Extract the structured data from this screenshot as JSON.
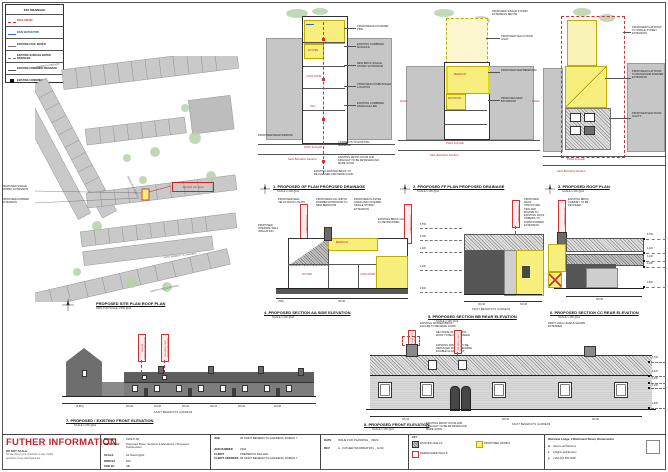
{
  "colors": {
    "accent_red": "#c0272d",
    "proposed_yellow": "#f6ef7d",
    "existing_gray": "#565656",
    "map_gray": "#c6c6c6",
    "tree_green": "#b7d2ab",
    "rain_blue": "#2d6fc0"
  },
  "legend": {
    "title": "KEY DRAINAGE",
    "items": [
      {
        "label": "FOUL DRAIN",
        "symbol": "red-dashed-line"
      },
      {
        "label": "RAIN WATER PIPE",
        "symbol": "blue-line"
      },
      {
        "label": "EXISTING FOUL WATER",
        "symbol": "gray-line"
      },
      {
        "label": "EXISTING SURFACE WATER DRAINAGE",
        "symbol": "gray-line"
      },
      {
        "label": "EXISTING COMBINED DRAINAGE",
        "symbol": "gray-line"
      },
      {
        "label": "EXISTING COMBINED RJ",
        "symbol": "black-square"
      }
    ]
  },
  "site_plan": {
    "caption": "PROPOSED SITE PLAN ROOF PLAN",
    "scale": "DWG P-60   SCALE 1:500 @A1",
    "streets": {
      "top": "HAMPDEN PARADE",
      "left": "GERALDINE STREET",
      "middle": "SAINT BENEDICTS GARDENS",
      "bottom": "NORTH CIRCULAR ROAD"
    },
    "notes": [
      "PROPOSED SINGLE STOREY EXTENSION",
      "PROPOSED DORMER EXTENSION"
    ],
    "site_label": "Site Red Line Area"
  },
  "plans": [
    {
      "num": "1.",
      "caption": "PROPOSED GF PLAN PROPOSED DRAINAGE",
      "scale": "SCALE 1:100 @A1",
      "rooms": [
        "KITCHEN",
        "LIVING ROOM",
        "HALL"
      ],
      "notes_right": [
        "PROPOSED RAIN WATER PIPE",
        "EXISTING COMBINED MANHOLE",
        "NEW BRICK SINGLE STOREY EXTENSION",
        "PROPOSED COMBI BOILER LOCATION",
        "EXISTING COMBINED DRAINAGE LINE"
      ],
      "note_left": "PROPOSED REAR WINDOW",
      "notes_bottom": [
        "CONNECTS TO EXISTING MANHOLE",
        "EXISTING FRONT DOOR AND FANLIGHT TO BE RETAINED AND MADE GOOD",
        "EXISTING PAINTED BRICK TO BE CLEANED AND MADE GOOD"
      ],
      "footpath": "Public Footpath",
      "street": "Saint Benedicts Gardens"
    },
    {
      "num": "2.",
      "caption": "PROPOSED FF PLAN PROPOSED DRAINAGE",
      "scale": "SCALE 1:100 @A1",
      "rooms": [
        "BEDROOM",
        "BATHROOM"
      ],
      "note_top": "PROPOSED SINGLE STOREY EXTENSION BELOW",
      "notes_right": [
        "PROPOSED VELUX ROOF LIGHT",
        "PROPOSED NEW BEDROOM",
        "PROPOSED NEW BATHROOM"
      ],
      "road_left": "ROAD",
      "road_right": "ROAD",
      "footpath": "Public Footpath",
      "street": "Saint Benedicts Gardens"
    },
    {
      "num": "3.",
      "caption": "PROPOSED ROOF PLAN",
      "scale": "SCALE 1:100 @A1",
      "notes_right": [
        "PROPOSED FLAT ROOF TO SINGLE STOREY EXTENSION",
        "PROPOSED FLAT ROOF TO BATHROOM DORMER EXTENSION",
        "PROPOSED NEW ROOF LIGHTS"
      ],
      "footpath": "Public Footpath",
      "street": "Saint Benedicts Gardens"
    }
  ],
  "sections": [
    {
      "num": "4.",
      "caption": "PROPOSED SECTION AA SIDE ELEVATION",
      "scale": "SCALE 1:100 @A1",
      "notes": [
        "PROPOSED NEW VELUX ROOF LIGHTS",
        "PROPOSED FULL WIDTH DORMER EXTENSION TO NEW BEDROOM",
        "PROPOSED PLASTER LINED AND COVERED SINGLE STOREY EXTENSION",
        "EXISTING BRICK CHIMNEY TO BE RETAINED",
        "PROPOSED INTERNAL WALL INSULATION"
      ],
      "rooms": [
        "BEDROOM",
        "KITCHEN",
        "LIVING ROOM"
      ],
      "flag": "SITE BOUNDARY",
      "dims": [
        "(765)",
        "NO.36"
      ]
    },
    {
      "num": "5.",
      "caption": "PROPOSED SECTION BB REAR ELEVATION",
      "scale": "SCALE 1:100 @A1",
      "note_top": "PROPOSED ROOF STRUCTURE TIED AND BOLTED TO EXISTING ROOF TIMBERS TO FORM DORMER EXTENSION",
      "levels": [
        "5,765",
        "5,100",
        "4,420",
        "2,400",
        "0,000"
      ],
      "flag": "SITE BOUNDARY",
      "dims": [
        "NO.36",
        "NO.38"
      ],
      "street": "SAINT BENEDICTS GARDENS",
      "note_bottom": "EXISTING PAINTED BRICK FACADE TO BE MADE GOOD"
    },
    {
      "num": "6.",
      "caption": "PROPOSED SECTION CC REAR ELEVATION",
      "scale": "SCALE 1:100 @A1",
      "note_top": "EXISTING BRICK CHIMNEY TO BE RETAINED",
      "levels": [
        "5,765",
        "4,420",
        "3,100",
        "2,400",
        "0,000"
      ],
      "flag": "SITE BOUNDARY",
      "dims": [
        "NO.36"
      ],
      "note_bottom": "PARTY WALL LEVELS SHOWN EXTENDED"
    }
  ],
  "elevations": [
    {
      "num": "7.",
      "caption": "PROPOSED / EXISTING FRONT ELEVATION",
      "scale": "SCALE 1:200 @A1",
      "flags": [
        "PROPOSED DORMER BEHIND",
        "PROPOSED ROOF LIGHTS BEHIND"
      ],
      "dims": [
        "(6,851)",
        "NO.28",
        "NO.30",
        "NO.32",
        "NO.34",
        "NO.36",
        "NO.38"
      ],
      "street": "SAINT BENEDICTS GARDENS"
    },
    {
      "num": "8.",
      "caption": "PROPOSED FRONT ELEVATION",
      "scale": "SCALE 1:100 @A1",
      "flags": [
        "PROPOSED DORMER BEHIND",
        "PROPOSED ROOF LIGHTS BEHIND"
      ],
      "notes": [
        "SECTIONS OF EXISTING ROOF TO BE DEMOLISHED",
        "EXISTING WINDOW TO BE REPLACED WITH OPENABLE DOUBLE GLAZED UNIT"
      ],
      "note_bottom": "EXISTING FRONT DOOR AND FANLIGHT TO BE RETAINED AND MADE GOOD",
      "levels": [
        "5,765",
        "4,420",
        "3,400",
        "3,100",
        "0,000"
      ],
      "dims": [
        "NO.34",
        "NO.36",
        "NO.38"
      ],
      "street": "SAINT BENEDICTS GARDENS"
    }
  ],
  "titleblock": {
    "further_title": "FUTHER INFORMATION",
    "do_not_scale": "DO NOT SCALE.",
    "note1": "All site dims to be checked on site. Notify",
    "note2": "architect of any discrepancies.",
    "dwg_no_label": "DWG NO",
    "dwg_no": "2302-P-60",
    "dwg_title_label": "DWG TITLE",
    "dwg_title": "Proposed Plans, Sections & Elevations / Proposed Construction",
    "scale_label": "SCALE",
    "scale": "As Noted @A1",
    "dwn_label": "DWN BY",
    "dwn": "DW",
    "ckd_label": "CKD BY",
    "ckd": "SB",
    "job_label": "JOB",
    "job": "36 SAINT BENEDICTS GARDENS, DUBLIN 7",
    "job_no_label": "JOB NUMBER",
    "job_no": "2302",
    "client_label": "CLIENT",
    "client": "FREDERICK MULLEN",
    "client_addr_label": "CLIENT ADDRESS",
    "client_addr": "36 SAINT BENEDICTS GARDENS, DUBLIN 7",
    "date_label": "DATE",
    "date": "ISSUE FOR PLANNING _ 09/23",
    "rev_label": "REV",
    "rev": "A - FUTHER INFORMATION _ 11/23",
    "key_label": "KEY",
    "key_existing": "EXISTING WALLS",
    "key_demolished": "DEMOLISHED WALLS",
    "key_proposed": "PROPOSED WORKS",
    "firm": "Richview Lodge, 2 Richmond Street, Drumcondra",
    "web_label": "w",
    "web": "www.rv-architects.ie",
    "email_label": "e",
    "email": "info@rv-architects.ie",
    "phone_label": "p",
    "phone": "+353 (0)1 830 0000"
  }
}
